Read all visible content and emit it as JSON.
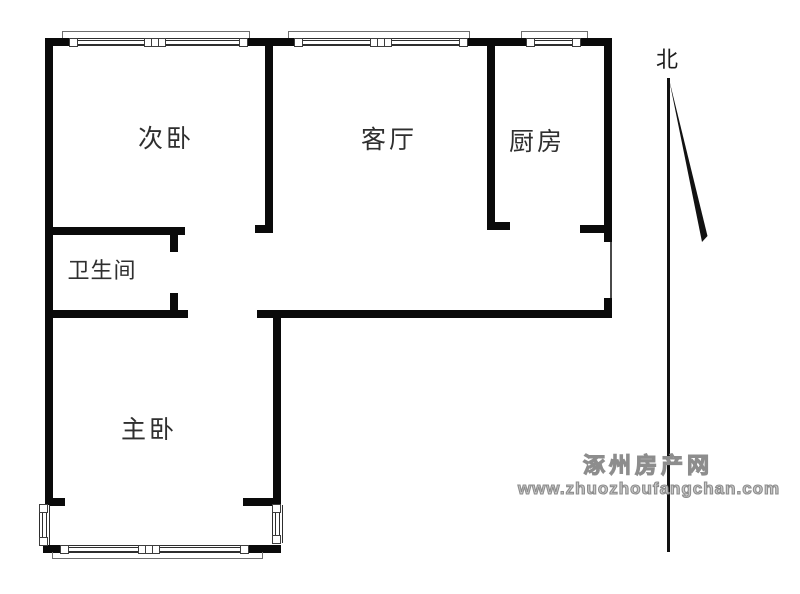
{
  "plan": {
    "rooms": [
      {
        "name": "secondary-bedroom",
        "label": "次卧"
      },
      {
        "name": "living-room",
        "label": "客厅"
      },
      {
        "name": "kitchen",
        "label": "厨房"
      },
      {
        "name": "bathroom",
        "label": "卫生间"
      },
      {
        "name": "master-bedroom",
        "label": "主卧"
      }
    ],
    "compass": {
      "label": "北"
    },
    "watermark": {
      "site": "涿州房产网",
      "url": "www.zhuozhoufangchan.com"
    },
    "colors": {
      "wall": "#0a0a0a",
      "background": "#ffffff",
      "label_text": "#2f2f2f",
      "watermark_gray": "#8d8d8d"
    }
  }
}
